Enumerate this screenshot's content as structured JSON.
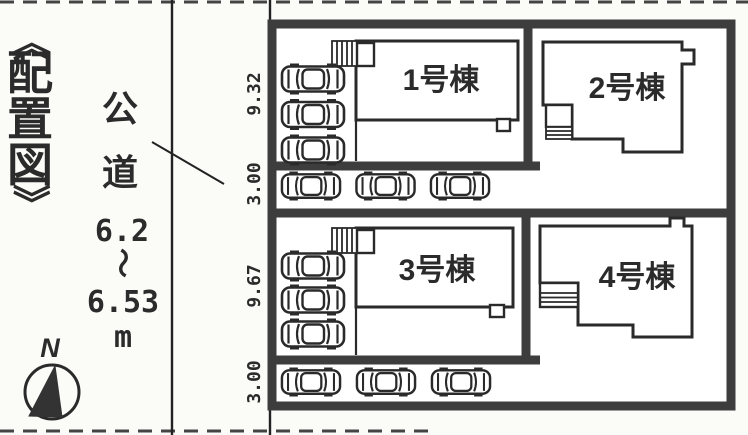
{
  "title": {
    "open": "《",
    "chars": [
      "配",
      "置",
      "図"
    ],
    "close": "》"
  },
  "road": {
    "label_chars": [
      "公",
      "道"
    ],
    "width_note": {
      "min": "6.2",
      "tilde": "〜",
      "max": "6.53",
      "unit": "m"
    }
  },
  "compass": {
    "north_label": "N"
  },
  "site": {
    "buildings": [
      {
        "label": "1号棟"
      },
      {
        "label": "2号棟"
      },
      {
        "label": "3号棟"
      },
      {
        "label": "4号棟"
      }
    ],
    "dimensions": [
      {
        "value": "9.32"
      },
      {
        "value": "3.00"
      },
      {
        "value": "9.67"
      },
      {
        "value": "3.00"
      }
    ]
  },
  "parking": {
    "groups": [
      {
        "name": "building1-side-spots",
        "count": 3,
        "x": 280,
        "y": 63,
        "dx": 0,
        "dy": 35.5,
        "w": 66,
        "h": 32
      },
      {
        "name": "building1-front-row",
        "count": 3,
        "x": 278,
        "y": 171,
        "dx": 74.5,
        "dy": 0,
        "w": 66,
        "h": 30
      },
      {
        "name": "building3-side-spots",
        "count": 3,
        "x": 280,
        "y": 250,
        "dx": 0,
        "dy": 34,
        "w": 66,
        "h": 32
      },
      {
        "name": "building3-front-row",
        "count": 3,
        "x": 278,
        "y": 367,
        "dx": 75,
        "dy": 0,
        "w": 66,
        "h": 30
      }
    ]
  },
  "colors": {
    "ink": "#2b2b2b",
    "border": "#3d3d3d",
    "background": "#fbfbf8"
  }
}
